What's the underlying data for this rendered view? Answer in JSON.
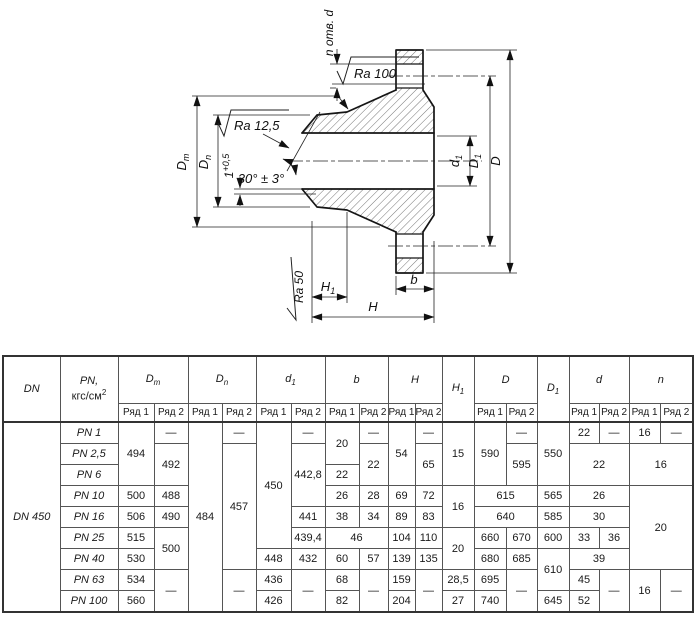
{
  "drawing": {
    "n_holes_label": "n отв. d",
    "ra_top": "Ra 100",
    "ra_cone": "Ra 12,5",
    "ra_face": "Ra 50",
    "angle_label": "30° ± 3°",
    "dim_dm": {
      "main": "D",
      "sub": "m"
    },
    "dim_dn": {
      "main": "D",
      "sub": "n"
    },
    "dim_root": {
      "main": "1",
      "sup": "+0,5"
    },
    "dim_h1": {
      "main": "H",
      "sub": "1"
    },
    "dim_h": "H",
    "dim_b": "b",
    "dim_d1": {
      "main": "d",
      "sub": "1"
    },
    "dim_D1": {
      "main": "D",
      "sub": "1"
    },
    "dim_D": "D"
  },
  "table": {
    "rad1": "Ряд 1",
    "rad2": "Ряд 2",
    "col_dn": "DN",
    "col_pn": {
      "line1": "PN,",
      "line2": "кгс/см",
      "sup": "2"
    },
    "groups": {
      "dm": {
        "main": "D",
        "sub": "m"
      },
      "dn": {
        "main": "D",
        "sub": "n"
      },
      "d1": {
        "main": "d",
        "sub": "1"
      },
      "b": {
        "main": "b",
        "sub": ""
      },
      "h": {
        "main": "H",
        "sub": ""
      },
      "h1": {
        "main": "H",
        "sub": "1"
      },
      "D": {
        "main": "D",
        "sub": ""
      },
      "D1": {
        "main": "D",
        "sub": "1"
      },
      "d": {
        "main": "d",
        "sub": ""
      },
      "n": {
        "main": "n",
        "sub": ""
      }
    },
    "rows": [
      [
        {
          "v": "DN 450",
          "rs": 9,
          "cls": "it"
        },
        {
          "v": "PN 1",
          "cls": "it"
        },
        {
          "v": "494",
          "rs": 3
        },
        {
          "v": "—"
        },
        {
          "v": "484",
          "rs": 9
        },
        {
          "v": "—"
        },
        {
          "v": "450",
          "rs": 6
        },
        {
          "v": "—"
        },
        {
          "v": "20",
          "rs": 2
        },
        {
          "v": "—"
        },
        {
          "v": "54",
          "rs": 3
        },
        {
          "v": "—"
        },
        {
          "v": "15",
          "rs": 3
        },
        {
          "v": "590",
          "rs": 3
        },
        {
          "v": "—"
        },
        {
          "v": "550",
          "rs": 3
        },
        {
          "v": "22"
        },
        {
          "v": "—"
        },
        {
          "v": "16"
        },
        {
          "v": "—"
        }
      ],
      [
        {
          "v": "PN 2,5",
          "cls": "it"
        },
        {
          "v": "492",
          "rs": 2
        },
        {
          "v": "457",
          "rs": 6
        },
        {
          "v": "442,8",
          "rs": 3
        },
        {
          "v": "22",
          "rs": 2
        },
        {
          "v": "65",
          "rs": 2
        },
        {
          "v": "595",
          "rs": 2
        },
        {
          "v": "22",
          "cs": 2,
          "rs": 2
        },
        {
          "v": "16",
          "cs": 2,
          "rs": 2
        }
      ],
      [
        {
          "v": "PN 6",
          "cls": "it"
        },
        {
          "v": "22"
        }
      ],
      [
        {
          "v": "PN 10",
          "cls": "it"
        },
        {
          "v": "500"
        },
        {
          "v": "488"
        },
        {
          "v": "26"
        },
        {
          "v": "28"
        },
        {
          "v": "69"
        },
        {
          "v": "72"
        },
        {
          "v": "16",
          "rs": 2
        },
        {
          "v": "615",
          "cs": 2
        },
        {
          "v": "565"
        },
        {
          "v": "26",
          "cs": 2
        },
        {
          "v": "20",
          "cs": 2,
          "rs": 4
        }
      ],
      [
        {
          "v": "PN 16",
          "cls": "it"
        },
        {
          "v": "506"
        },
        {
          "v": "490"
        },
        {
          "v": "441"
        },
        {
          "v": "38"
        },
        {
          "v": "34"
        },
        {
          "v": "89"
        },
        {
          "v": "83"
        },
        {
          "v": "640",
          "cs": 2
        },
        {
          "v": "585"
        },
        {
          "v": "30",
          "cs": 2
        }
      ],
      [
        {
          "v": "PN 25",
          "cls": "it"
        },
        {
          "v": "515"
        },
        {
          "v": "500",
          "rs": 2
        },
        {
          "v": "439,4"
        },
        {
          "v": "46",
          "cs": 2
        },
        {
          "v": "104"
        },
        {
          "v": "110"
        },
        {
          "v": "20",
          "rs": 2
        },
        {
          "v": "660"
        },
        {
          "v": "670"
        },
        {
          "v": "600"
        },
        {
          "v": "33"
        },
        {
          "v": "36"
        }
      ],
      [
        {
          "v": "PN 40",
          "cls": "it"
        },
        {
          "v": "530"
        },
        {
          "v": "448"
        },
        {
          "v": "432"
        },
        {
          "v": "60"
        },
        {
          "v": "57"
        },
        {
          "v": "139"
        },
        {
          "v": "135"
        },
        {
          "v": "680"
        },
        {
          "v": "685"
        },
        {
          "v": "610",
          "rs": 2
        },
        {
          "v": "39",
          "cs": 2
        }
      ],
      [
        {
          "v": "PN 63",
          "cls": "it"
        },
        {
          "v": "534"
        },
        {
          "v": "—",
          "rs": 2
        },
        {
          "v": "—",
          "rs": 2
        },
        {
          "v": "436"
        },
        {
          "v": "—",
          "rs": 2
        },
        {
          "v": "68"
        },
        {
          "v": "—",
          "rs": 2
        },
        {
          "v": "159"
        },
        {
          "v": "—",
          "rs": 2
        },
        {
          "v": "28,5"
        },
        {
          "v": "695"
        },
        {
          "v": "—",
          "rs": 2
        },
        {
          "v": "45"
        },
        {
          "v": "—",
          "rs": 2
        },
        {
          "v": "16",
          "rs": 2
        },
        {
          "v": "—",
          "rs": 2
        }
      ],
      [
        {
          "v": "PN 100",
          "cls": "it"
        },
        {
          "v": "560"
        },
        {
          "v": "426"
        },
        {
          "v": "82"
        },
        {
          "v": "204"
        },
        {
          "v": "27"
        },
        {
          "v": "740"
        },
        {
          "v": "645"
        },
        {
          "v": "52"
        }
      ]
    ]
  }
}
